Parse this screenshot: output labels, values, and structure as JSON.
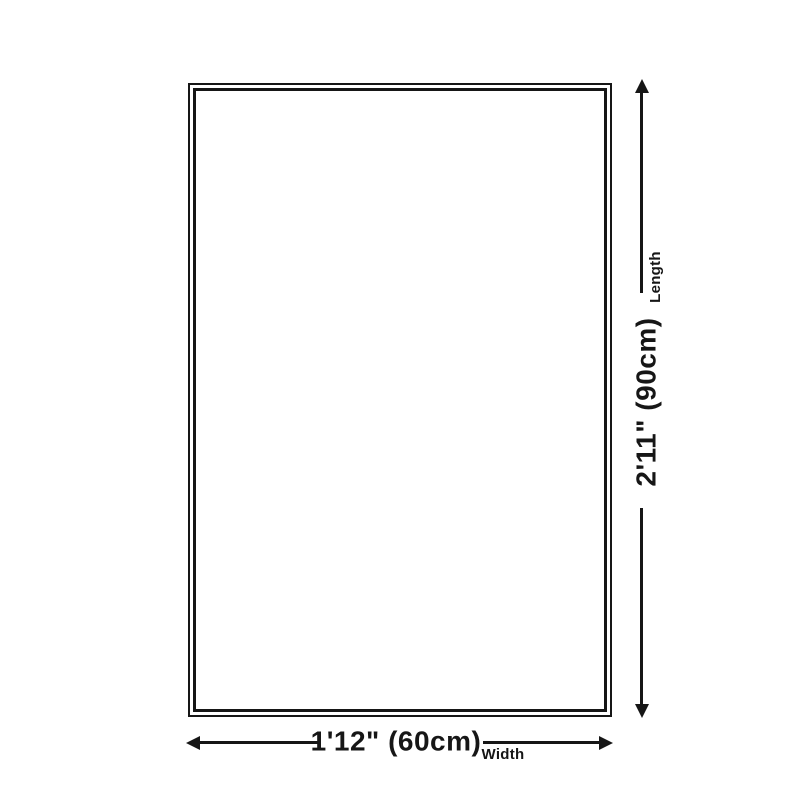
{
  "diagram": {
    "length": {
      "value": "2'11\" (90cm)",
      "label": "Length"
    },
    "width": {
      "value": "1'12\" (60cm)",
      "label": "Width"
    }
  },
  "colors": {
    "ink": "#161616",
    "bg": "#ffffff"
  }
}
